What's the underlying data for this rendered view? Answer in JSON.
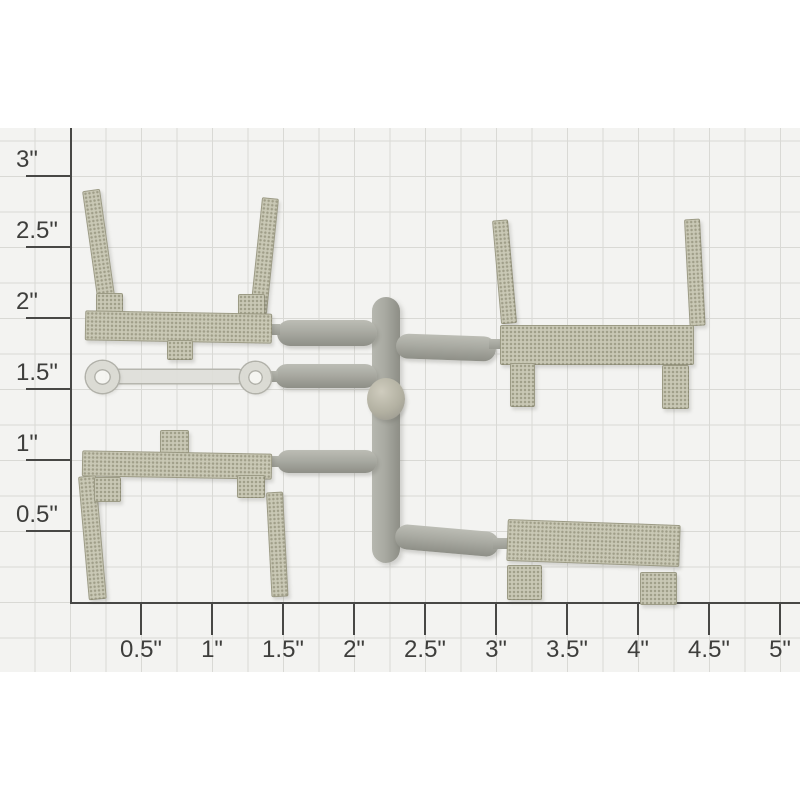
{
  "image_type": "product-photo-of-plastic-model-sprue-on-measuring-grid",
  "ruler": {
    "unit": "inches",
    "x_labels": [
      "0.5\"",
      "1\"",
      "1.5\"",
      "2\"",
      "2.5\"",
      "3\"",
      "3.5\"",
      "4\"",
      "4.5\"",
      "5\""
    ],
    "y_labels_bottom_up": [
      "0.5\"",
      "1\"",
      "1.5\"",
      "2\"",
      "2.5\"",
      "3\""
    ],
    "tick_spacing_px": 71,
    "grid_spacing_px": 35.5,
    "axis_color": "#474745",
    "label_color": "#3e3e3c",
    "grid_color": "#d9d9d5",
    "paper_color": "#f3f3f1"
  },
  "parts": {
    "molded_part_color": "#c9c8b5",
    "runner_color": "#a9aaa2",
    "translucent_link_color": "#dededa",
    "items": [
      "upper-left-bracket-part",
      "upper-right-bracket-part",
      "lower-left-bracket-part",
      "lower-right-bracket-part",
      "translucent-link-part",
      "sprue-runner"
    ]
  }
}
